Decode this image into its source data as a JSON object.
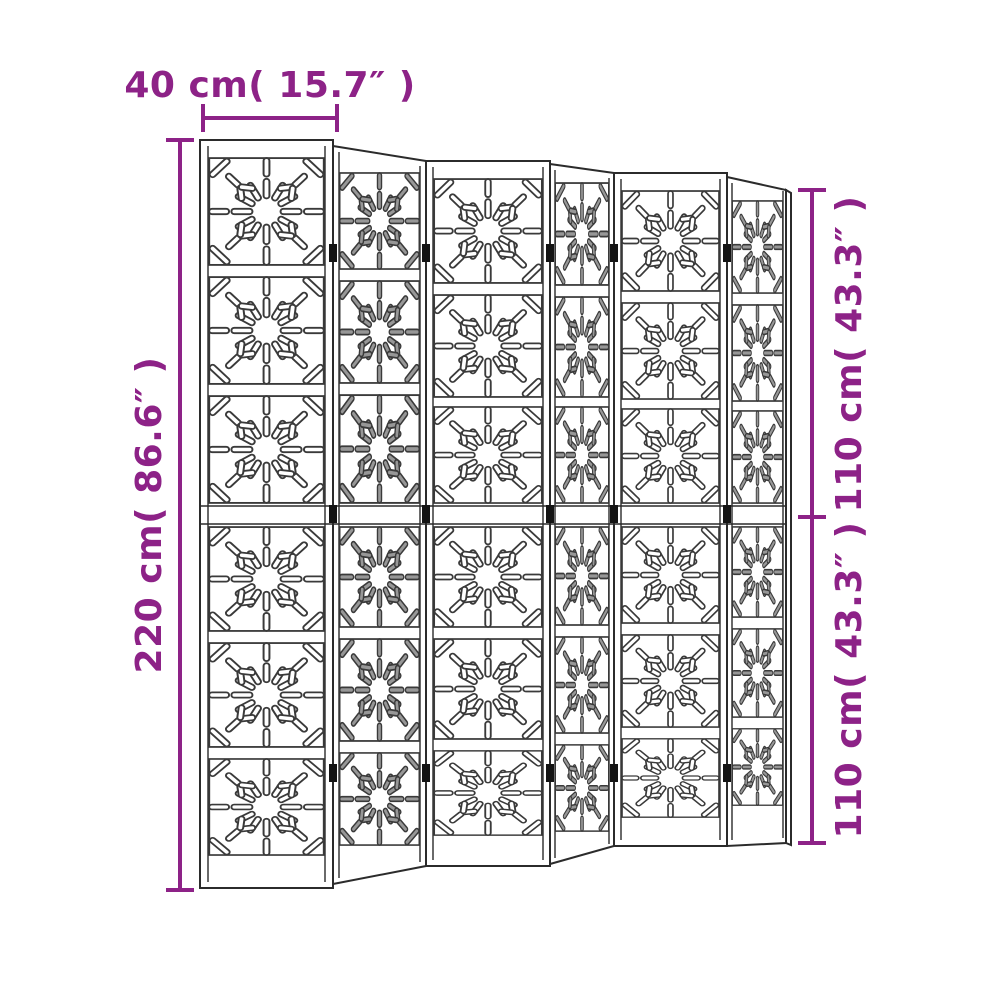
{
  "diagram": {
    "description": "Line drawing of a six-panel folding room divider screen with decorative starburst cut-out tiles, annotated with product dimensions",
    "panel_count": 6,
    "tiles_per_panel": 6,
    "dimensions": {
      "panel_width": {
        "label": "40 cm( 15.7″ )"
      },
      "total_height": {
        "label": "220 cm( 86.6″ )"
      },
      "upper_section_height": {
        "label": "110 cm( 43.3″ )"
      },
      "lower_section_height": {
        "label": "110 cm( 43.3″ )"
      }
    },
    "colors": {
      "dimension_accent": "#8d2287",
      "line_art": "#2b2b2b",
      "background": "#ffffff",
      "angled_slot_shading": "#979797"
    }
  }
}
